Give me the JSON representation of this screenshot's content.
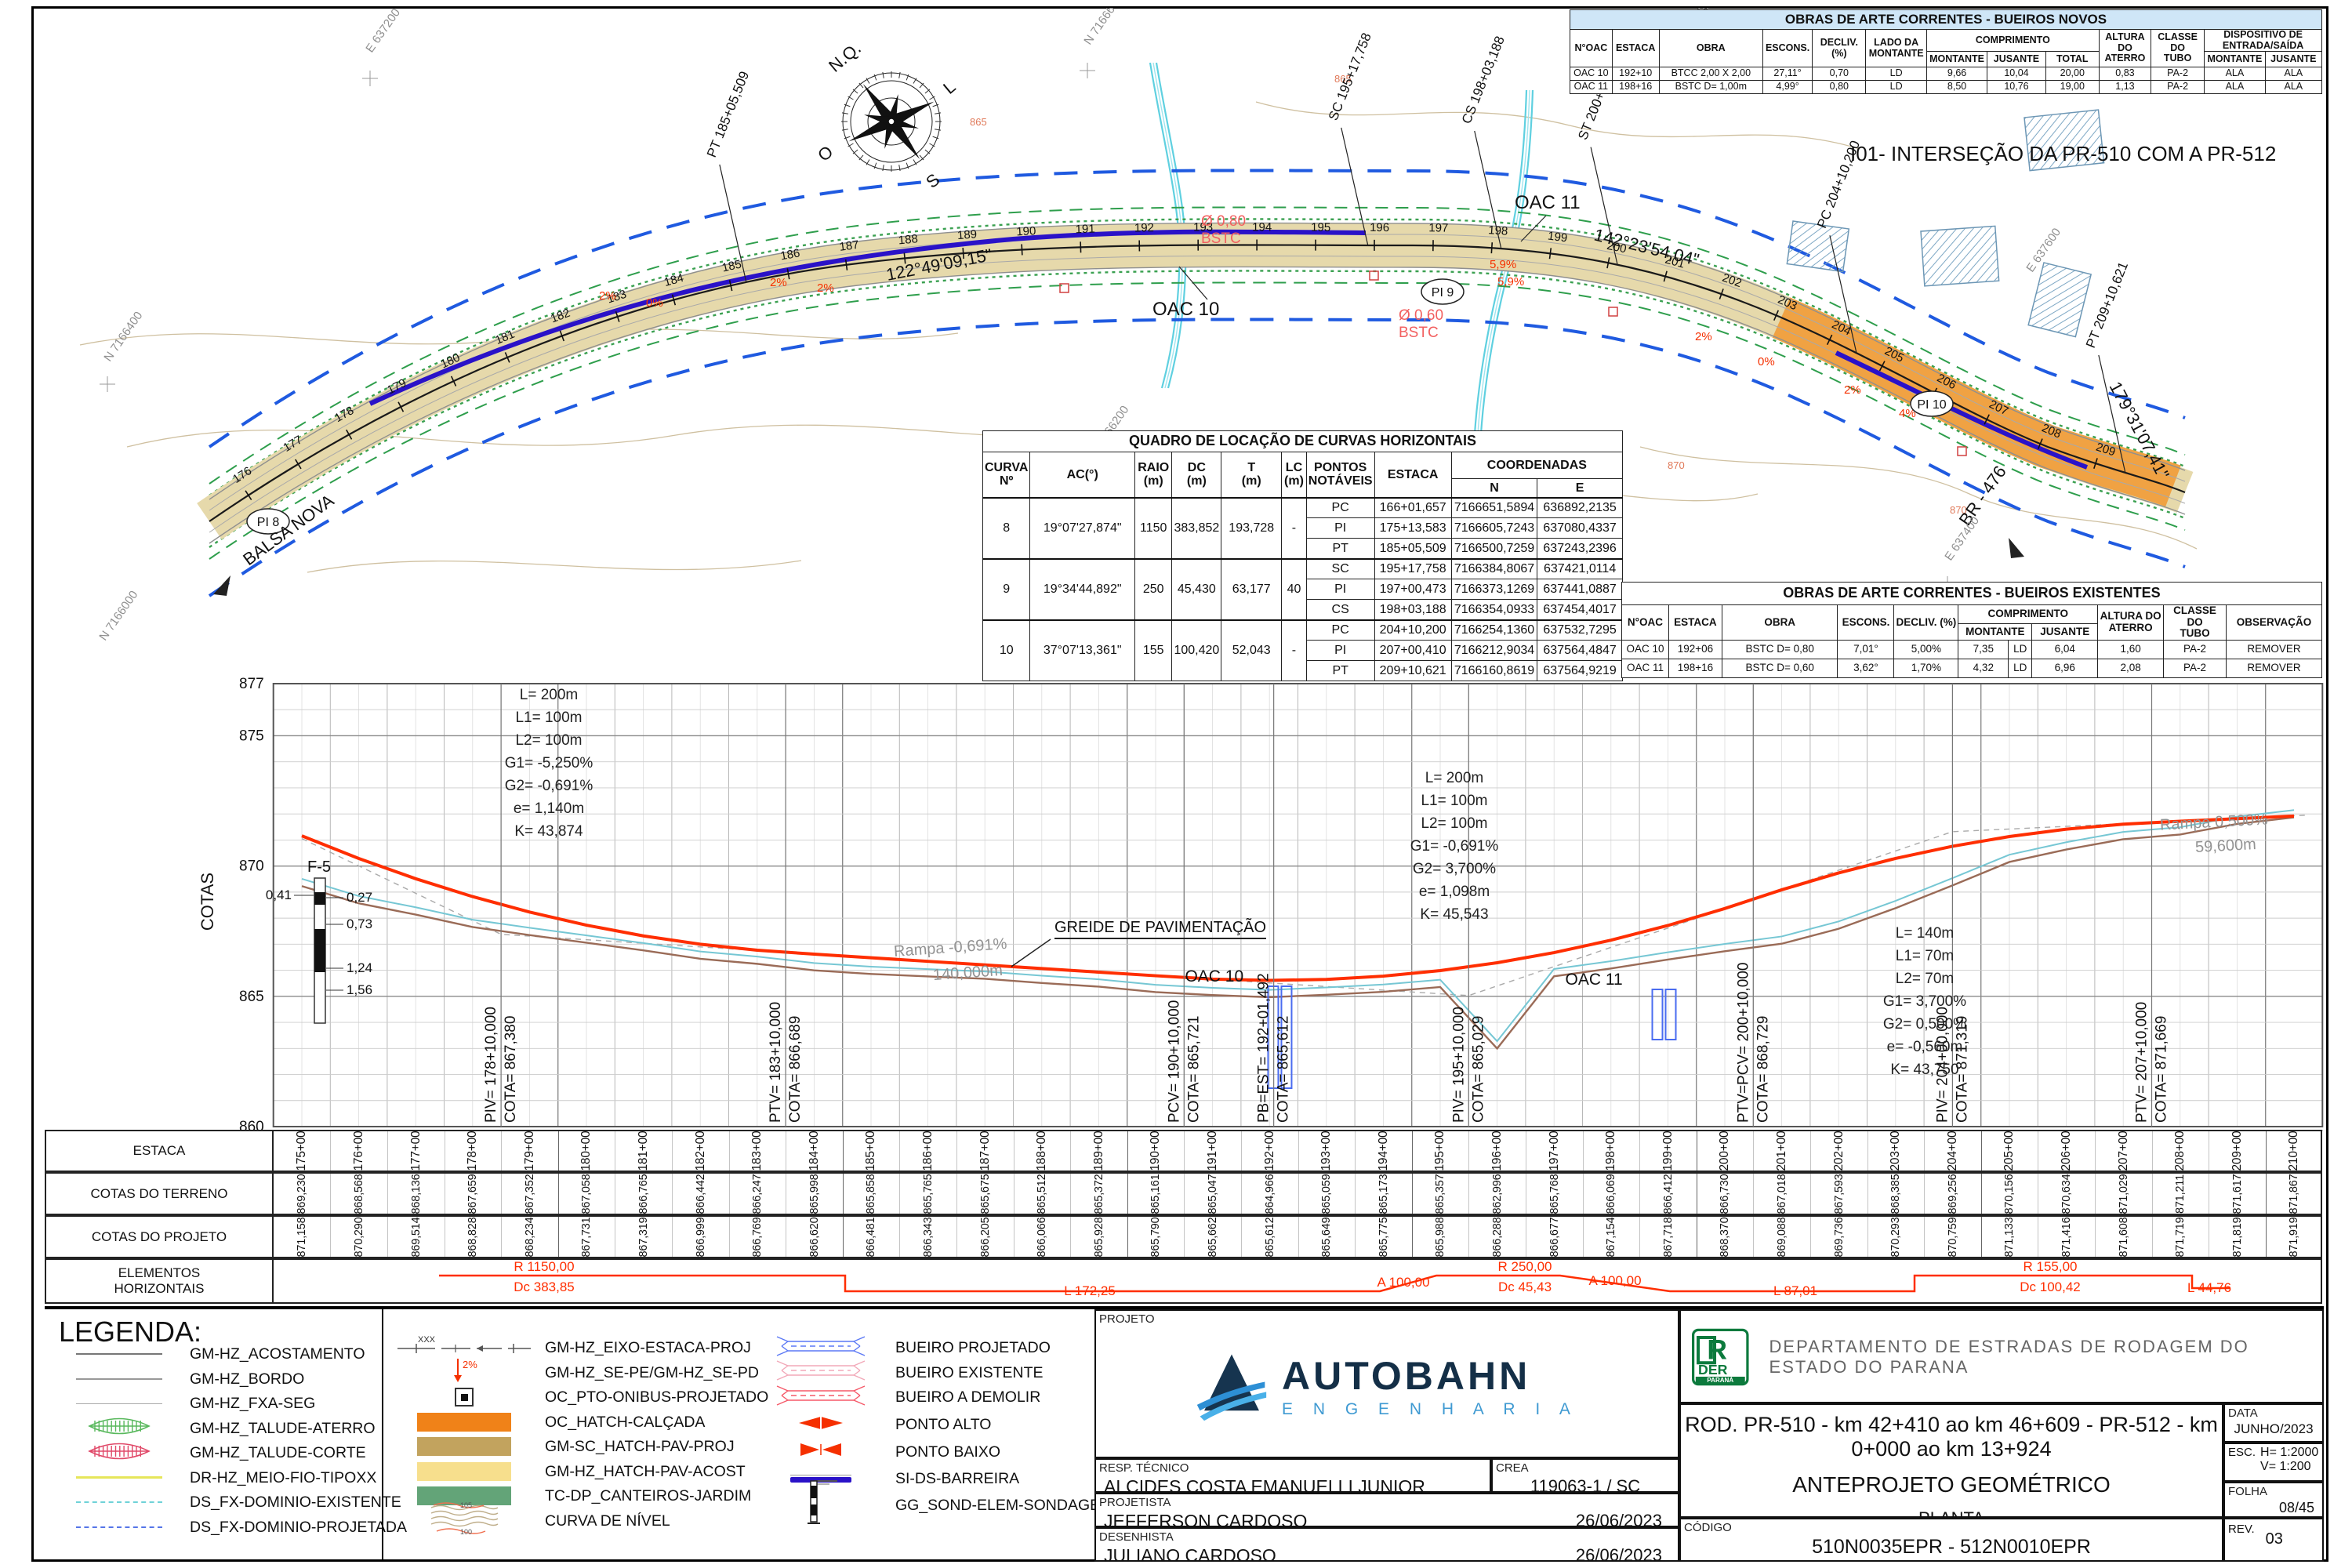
{
  "plan": {
    "compass": {
      "north": "N.Q.",
      "east": "L",
      "south": "S",
      "west": "O"
    },
    "intersection_note": "I01- INTERSEÇÃO DA PR-510 COM A PR-512",
    "place": "BALSA NOVA",
    "road": "BR - 476",
    "pi_markers": [
      "PI 8",
      "PI 9",
      "PI 10"
    ],
    "oac_labels": [
      "OAC 10",
      "OAC 11"
    ],
    "azimuths": [
      "122°49'09,15\"",
      "142°23'54,04\"",
      "179°31'07,41\""
    ],
    "point_leaders": [
      "PT 185+05,509",
      "SC 195+17,758",
      "CS 198+03,188",
      "ST 200+03,188",
      "PC 204+10,200",
      "PT 209+10,621"
    ],
    "culvert_notes": [
      [
        "Ø 0,80",
        "BSTC"
      ],
      [
        "Ø 0,60",
        "BSTC"
      ]
    ],
    "slope_marks": [
      "2%",
      "0%",
      "2%",
      "2%",
      "5,9%",
      "5,9%",
      "2%",
      "0%",
      "2%",
      "4%"
    ],
    "contour_labels": [
      "865",
      "865",
      "870",
      "870"
    ],
    "grid_labels": [
      "E 637200",
      "N 7166600",
      "E 637600",
      "N 7166800",
      "N 7166400",
      "N 7166000",
      "N 7166200",
      "E 637400"
    ],
    "station_first": 176,
    "station_last": 209
  },
  "tables": {
    "bueiros_novos": {
      "title": "OBRAS DE ARTE CORRENTES - BUEIROS NOVOS",
      "h_simple": [
        "N°OAC",
        "ESTACA",
        "OBRA",
        "ESCONS.",
        "DECLIV. (%)",
        "LADO DA\nMONTANTE"
      ],
      "h_comprimento": "COMPRIMENTO",
      "h_comprimento_sub": [
        "MONTANTE",
        "JUSANTE",
        "TOTAL"
      ],
      "h_tail": [
        "ALTURA DO\nATERRO",
        "CLASSE DO\nTUBO"
      ],
      "h_dispositivo": "DISPOSITIVO DE\nENTRADA/SAÍDA",
      "h_dispositivo_sub": [
        "MONTANTE",
        "JUSANTE"
      ],
      "rows": [
        [
          "OAC 10",
          "192+10",
          "BTCC 2,00 X 2,00",
          "27,11°",
          "0,70",
          "LD",
          "9,66",
          "10,04",
          "20,00",
          "0,83",
          "PA-2",
          "ALA",
          "ALA"
        ],
        [
          "OAC 11",
          "198+16",
          "BSTC D= 1,00m",
          "4,99°",
          "0,80",
          "LD",
          "8,50",
          "10,76",
          "19,00",
          "1,13",
          "PA-2",
          "ALA",
          "ALA"
        ]
      ]
    },
    "curvas": {
      "title": "QUADRO DE LOCAÇÃO DE CURVAS HORIZONTAIS",
      "headers": [
        "CURVA\nNº",
        "AC(°)",
        "RAIO\n(m)",
        "DC\n(m)",
        "T\n(m)",
        "LC\n(m)",
        "PONTOS\nNOTÁVEIS",
        "ESTACA",
        "COORDENADAS",
        "N",
        "E"
      ],
      "rows": [
        {
          "curva": "8",
          "ac": "19°07'27,874\"",
          "raio": "1150",
          "dc": "383,852",
          "t": "193,728",
          "lc": "-",
          "points": [
            [
              "PC",
              "166+01,657",
              "7166651,5894",
              "636892,2135"
            ],
            [
              "PI",
              "175+13,583",
              "7166605,7243",
              "637080,4337"
            ],
            [
              "PT",
              "185+05,509",
              "7166500,7259",
              "637243,2396"
            ]
          ]
        },
        {
          "curva": "9",
          "ac": "19°34'44,892\"",
          "raio": "250",
          "dc": "45,430",
          "t": "63,177",
          "lc": "40",
          "points": [
            [
              "SC",
              "195+17,758",
              "7166384,8067",
              "637421,0114"
            ],
            [
              "PI",
              "197+00,473",
              "7166373,1269",
              "637441,0887"
            ],
            [
              "CS",
              "198+03,188",
              "7166354,0933",
              "637454,4017"
            ]
          ]
        },
        {
          "curva": "10",
          "ac": "37°07'13,361\"",
          "raio": "155",
          "dc": "100,420",
          "t": "52,043",
          "lc": "-",
          "points": [
            [
              "PC",
              "204+10,200",
              "7166254,1360",
              "637532,7295"
            ],
            [
              "PI",
              "207+00,410",
              "7166212,9034",
              "637564,4847"
            ],
            [
              "PT",
              "209+10,621",
              "7166160,8619",
              "637564,9219"
            ]
          ]
        }
      ]
    },
    "bueiros_existentes": {
      "title": "OBRAS DE ARTE CORRENTES - BUEIROS EXISTENTES",
      "h_simple": [
        "N°OAC",
        "ESTACA",
        "OBRA",
        "ESCONS.",
        "DECLIV. (%)"
      ],
      "h_comprimento": "COMPRIMENTO",
      "h_comprimento_sub": [
        "MONTANTE",
        "JUSANTE"
      ],
      "h_tail": [
        "ALTURA DO\nATERRO",
        "CLASSE DO\nTUBO",
        "OBSERVAÇÃO"
      ],
      "rows": [
        [
          "OAC 10",
          "192+06",
          "BSTC D= 0,80",
          "7,01°",
          "5,00%",
          "7,35",
          "LD",
          "6,04",
          "1,60",
          "PA-2",
          "REMOVER"
        ],
        [
          "OAC 11",
          "198+16",
          "BSTC D= 0,60",
          "3,62°",
          "1,70%",
          "4,32",
          "LD",
          "6,96",
          "2,08",
          "PA-2",
          "REMOVER"
        ]
      ]
    }
  },
  "chart_data": {
    "type": "line",
    "title": "Perfil longitudinal - greide e terreno",
    "xlabel": "ESTACA",
    "ylabel": "COTAS",
    "ylim": [
      860,
      877
    ],
    "x": [
      175,
      176,
      177,
      178,
      179,
      180,
      181,
      182,
      183,
      184,
      185,
      186,
      187,
      188,
      189,
      190,
      191,
      192,
      193,
      194,
      195,
      196,
      197,
      198,
      199,
      200,
      201,
      202,
      203,
      204,
      205,
      206,
      207,
      208,
      209,
      210
    ],
    "series": [
      {
        "name": "COTAS DO TERRENO",
        "values": [
          869.23,
          868.568,
          868.136,
          867.659,
          867.352,
          867.058,
          866.765,
          866.442,
          866.247,
          865.998,
          865.858,
          865.765,
          865.675,
          865.512,
          865.372,
          865.161,
          865.047,
          864.966,
          865.059,
          865.173,
          865.357,
          862.996,
          865.768,
          866.069,
          866.412,
          866.73,
          867.018,
          867.593,
          868.385,
          869.256,
          870.156,
          870.634,
          871.029,
          871.211,
          871.617,
          871.867
        ]
      },
      {
        "name": "COTAS DO PROJETO",
        "values": [
          871.158,
          870.29,
          869.514,
          868.828,
          868.234,
          867.731,
          867.319,
          866.999,
          866.769,
          866.62,
          866.481,
          866.343,
          866.205,
          866.066,
          865.928,
          865.79,
          865.662,
          865.612,
          865.649,
          865.775,
          865.988,
          866.288,
          866.677,
          867.154,
          867.718,
          868.37,
          869.088,
          869.736,
          870.293,
          870.759,
          871.133,
          871.416,
          871.608,
          871.719,
          871.819,
          871.919
        ]
      }
    ]
  },
  "profile": {
    "ylabel": "COTAS",
    "yticks": [
      "877",
      "875",
      "870",
      "865",
      "860"
    ],
    "greide_label": "GREIDE DE PAVIMENTAÇÃO",
    "ramps": [
      [
        "Rampa -0,691%",
        "140,000m"
      ],
      [
        "Rampa 0,500%",
        "59,600m"
      ]
    ],
    "oac_labels": [
      "OAC 10",
      "OAC 11"
    ],
    "borehole": {
      "name": "F-5",
      "side": "0,41",
      "depths": [
        "0,27",
        "0,73",
        "1,24",
        "1,56"
      ]
    },
    "curve_blocks": [
      [
        "L= 200m",
        "L1= 100m",
        "L2= 100m",
        "G1= -5,250%",
        "G2= -0,691%",
        "e= 1,140m",
        "K= 43,874"
      ],
      [
        "L= 200m",
        "L1= 100m",
        "L2= 100m",
        "G1= -0,691%",
        "G2= 3,700%",
        "e= 1,098m",
        "K= 45,543"
      ],
      [
        "L= 140m",
        "L1= 70m",
        "L2= 70m",
        "G1= 3,700%",
        "G2= 0,500%",
        "e= -0,560m",
        "K= 43,750"
      ]
    ],
    "vpoints": [
      {
        "a": "PIV= 178+10,000",
        "b": "COTA= 867,380",
        "s": 178.5
      },
      {
        "a": "PTV= 183+10,000",
        "b": "COTA= 866,689",
        "s": 183.5
      },
      {
        "a": "PCV= 190+10,000",
        "b": "COTA= 865,721",
        "s": 190.5
      },
      {
        "a": "PB=EST= 192+01,492",
        "b": "COTA= 865,612",
        "s": 192.075
      },
      {
        "a": "PIV= 195+10,000",
        "b": "COTA= 865,029",
        "s": 195.5
      },
      {
        "a": "PTV=PCV= 200+10,000",
        "b": "COTA= 868,729",
        "s": 200.5
      },
      {
        "a": "PIV= 204+00,000",
        "b": "COTA= 871,319",
        "s": 204.0
      },
      {
        "a": "PTV= 207+10,000",
        "b": "COTA= 871,669",
        "s": 207.5
      }
    ]
  },
  "grade_table": {
    "row_labels": [
      "ESTACA",
      "COTAS DO TERRENO",
      "COTAS DO PROJETO",
      "ELEMENTOS\nHORIZONTAIS"
    ],
    "estacas": [
      "175+00",
      "176+00",
      "177+00",
      "178+00",
      "179+00",
      "180+00",
      "181+00",
      "182+00",
      "183+00",
      "184+00",
      "185+00",
      "186+00",
      "187+00",
      "188+00",
      "189+00",
      "190+00",
      "191+00",
      "192+00",
      "193+00",
      "194+00",
      "195+00",
      "196+00",
      "197+00",
      "198+00",
      "199+00",
      "200+00",
      "201+00",
      "202+00",
      "203+00",
      "204+00",
      "205+00",
      "206+00",
      "207+00",
      "208+00",
      "209+00",
      "210+00"
    ],
    "terreno": [
      "869,230",
      "868,568",
      "868,136",
      "867,659",
      "867,352",
      "867,058",
      "866,765",
      "866,442",
      "866,247",
      "865,998",
      "865,858",
      "865,765",
      "865,675",
      "865,512",
      "865,372",
      "865,161",
      "865,047",
      "864,966",
      "865,059",
      "865,173",
      "865,357",
      "862,996",
      "865,768",
      "866,069",
      "866,412",
      "866,730",
      "867,018",
      "867,593",
      "868,385",
      "869,256",
      "870,156",
      "870,634",
      "871,029",
      "871,211",
      "871,617",
      "871,867"
    ],
    "projeto": [
      "871,158",
      "870,290",
      "869,514",
      "868,828",
      "868,234",
      "867,731",
      "867,319",
      "866,999",
      "866,769",
      "866,620",
      "866,481",
      "866,343",
      "866,205",
      "866,066",
      "865,928",
      "865,790",
      "865,662",
      "865,612",
      "865,649",
      "865,775",
      "865,988",
      "866,288",
      "866,677",
      "867,154",
      "867,718",
      "868,370",
      "869,088",
      "869,736",
      "870,293",
      "870,759",
      "871,133",
      "871,416",
      "871,608",
      "871,719",
      "871,819",
      "871,919"
    ],
    "elements": {
      "r1": "R 1150,00",
      "dc1": "Dc 383,85",
      "l1": "L 172,25",
      "a1": "A 100,00",
      "r2": "R 250,00",
      "dc2": "Dc 45,43",
      "a2": "A 100,00",
      "l2": "L 87,01",
      "r3": "R 155,00",
      "dc3": "Dc 100,42",
      "l3": "L 44,76"
    }
  },
  "legend": {
    "title": "LEGENDA:",
    "col1": [
      {
        "sym": "line-gray",
        "label": "GM-HZ_ACOSTAMENTO"
      },
      {
        "sym": "line-gray2",
        "label": "GM-HZ_BORDO"
      },
      {
        "sym": "line-thin",
        "label": "GM-HZ_FXA-SEG"
      },
      {
        "sym": "talude-green",
        "label": "GM-HZ_TALUDE-ATERRO"
      },
      {
        "sym": "talude-red",
        "label": "GM-HZ_TALUDE-CORTE"
      },
      {
        "sym": "line-yellow",
        "label": "DR-HZ_MEIO-FIO-TIPOXX"
      },
      {
        "sym": "dashdot-cyan",
        "label": "DS_FX-DOMINIO-EXISTENTE"
      },
      {
        "sym": "dashdot-blue",
        "label": "DS_FX-DOMINIO-PROJETADA"
      }
    ],
    "col2": [
      {
        "sym": "eixo",
        "label": "GM-HZ_EIXO-ESTACA-PROJ"
      },
      {
        "sym": "arrow2",
        "label": "GM-HZ_SE-PE/GM-HZ_SE-PD"
      },
      {
        "sym": "busstop",
        "label": "OC_PTO-ONIBUS-PROJETADO"
      },
      {
        "sym": "swatch-orange",
        "label": "OC_HATCH-CALÇADA"
      },
      {
        "sym": "swatch-tan",
        "label": "GM-SC_HATCH-PAV-PROJ"
      },
      {
        "sym": "swatch-lightyellow",
        "label": "GM-HZ_HATCH-PAV-ACOST"
      },
      {
        "sym": "swatch-green",
        "label": "TC-DP_CANTEIROS-JARDIM"
      },
      {
        "sym": "contours",
        "label": "CURVA DE NÍVEL"
      }
    ],
    "col3": [
      {
        "sym": "culvert-blue",
        "label": "BUEIRO PROJETADO"
      },
      {
        "sym": "culvert-pink",
        "label": "BUEIRO EXISTENTE"
      },
      {
        "sym": "culvert-red",
        "label": "BUEIRO A DEMOLIR"
      },
      {
        "sym": "pt-alto",
        "label": "PONTO ALTO"
      },
      {
        "sym": "pt-baixo",
        "label": "PONTO BAIXO"
      },
      {
        "sym": "barreira",
        "label": "SI-DS-BARREIRA"
      },
      {
        "sym": "sondagem",
        "label": "GG_SOND-ELEM-SONDAGEM"
      }
    ]
  },
  "title_block": {
    "projeto_label": "PROJETO",
    "company": "AUTOBAHN",
    "company_sub": "E N G E N H A R I A",
    "resp_label": "RESP. TÉCNICO",
    "resp_name": "ALCIDES COSTA EMANUELLI JUNIOR",
    "crea_label": "CREA",
    "crea_value": "119063-1 / SC",
    "projetista_label": "PROJETISTA",
    "projetista_name": "JEFFERSON CARDOSO",
    "projetista_date": "26/06/2023",
    "desenhista_label": "DESENHISTA",
    "desenhista_name": "JULIANO CARDOSO",
    "desenhista_date": "26/06/2023",
    "der_logo_text": "DER",
    "der_logo_sub": "PARANÁ",
    "dept": "DEPARTAMENTO  DE  ESTRADAS  DE  RODAGEM  DO  ESTADO  DO  PARANA",
    "road_title": "ROD. PR-510 - km 42+410 ao km 46+609 - PR-512 - km 0+000 ao km 13+924",
    "doc_title": "ANTEPROJETO GEOMÉTRICO",
    "doc_subtitle": "PLANTA",
    "codigo_label": "CÓDIGO",
    "codigo_value": "510N0035EPR - 512N0010EPR",
    "data_label": "DATA",
    "data_value": "JUNHO/2023",
    "esc_label": "ESC.",
    "esc_h": "H= 1:2000",
    "esc_v": "V= 1:200",
    "folha_label": "FOLHA",
    "folha_value": "08/45",
    "rev_label": "REV.",
    "rev_value": "03"
  }
}
